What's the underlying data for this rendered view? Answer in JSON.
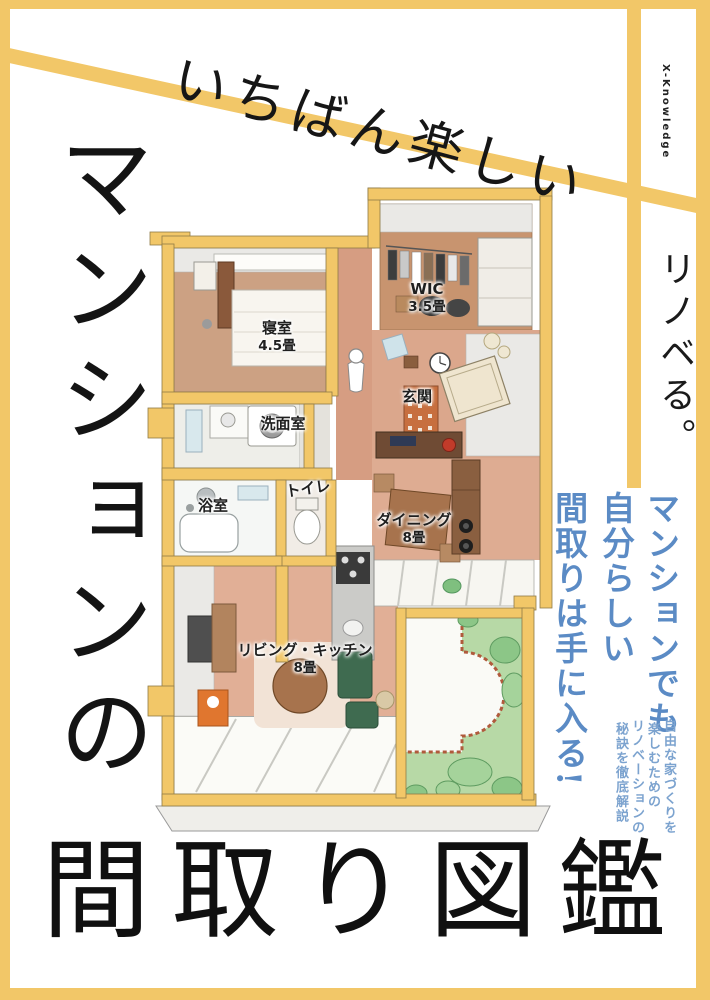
{
  "cover": {
    "publisher": "X-Knowledge",
    "brand": "リノベる。",
    "tagline": "いちばん楽しい",
    "title_vertical": "マンションの",
    "title_main": "間取り図鑑",
    "catch_lines": [
      "マンションでも",
      "自分らしい",
      "間取りは手に入る!"
    ],
    "catch_sub": [
      "自由な家づくりを",
      "楽しむための",
      "リノベーションの",
      "秘訣を徹底解説"
    ]
  },
  "floorplan": {
    "rooms": [
      {
        "id": "bedroom",
        "name": "寝室",
        "size": "4.5畳"
      },
      {
        "id": "wic",
        "name": "WIC",
        "size": "3.5畳"
      },
      {
        "id": "entrance",
        "name": "玄関",
        "size": ""
      },
      {
        "id": "washroom",
        "name": "洗面室",
        "size": ""
      },
      {
        "id": "toilet",
        "name": "トイレ",
        "size": ""
      },
      {
        "id": "bath",
        "name": "浴室",
        "size": ""
      },
      {
        "id": "dining",
        "name": "ダイニング",
        "size": "8畳"
      },
      {
        "id": "living",
        "name": "リビング・キッチン",
        "size": "8畳"
      }
    ]
  },
  "colors": {
    "accent_yellow": "#F2C768",
    "catch_blue": "#5B8BC5",
    "catch_blue_light": "#7CA3CF"
  }
}
